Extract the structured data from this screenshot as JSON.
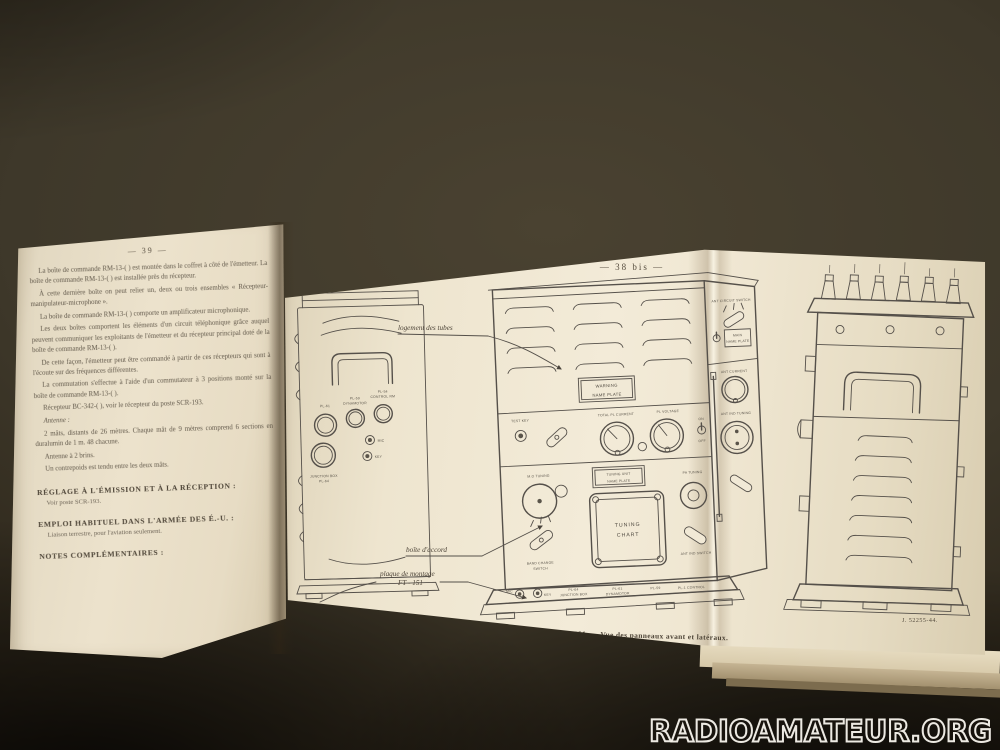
{
  "watermark": {
    "text": "RADIOAMATEUR.ORG"
  },
  "left_page": {
    "page_number": "— 39 —",
    "paragraphs": [
      "La boîte de commande RM-13-( ) est montée dans le coffret à côté de l'émetteur. La boîte de commande RM-13-( ) est installée près du récepteur.",
      "À cette dernière boîte on peut relier un, deux ou trois ensembles « Récepteur-manipulateur-microphone ».",
      "La boîte de commande RM-13-( ) comporte un amplificateur microphonique.",
      "Les deux boîtes comportent les éléments d'un circuit téléphonique grâce auquel peuvent communiquer les exploitants de l'émetteur et du récepteur principal doté de la boîte de commande RM-13-( ).",
      "De cette façon, l'émetteur peut être commandé à partir de ces récepteurs qui sont à l'écoute sur des fréquences différentes.",
      "La commutation s'effectue à l'aide d'un commutateur à 3 positions monté sur la boîte de commande RM-13-( ).",
      "Récepteur BC-342-( ), voir le récepteur du poste SCR-193.",
      "Antenne :",
      "2 mâts, distants de 26 mètres. Chaque mât de 9 mètres comprend 6 sections en duralumin de 1 m. 48 chacune.",
      "Antenne à 2 brins.",
      "Un contrepoids est tendu entre les deux mâts."
    ],
    "sections": [
      {
        "heading": "RÉGLAGE À L'ÉMISSION ET À LA RÉCEPTION :",
        "body": "Voir poste SCR-193."
      },
      {
        "heading": "EMPLOI HABITUEL DANS L'ARMÉE DES É.-U. :",
        "body": "Liaison terrestre, pour l'aviation seulement."
      },
      {
        "heading": "NOTES COMPLÉMENTAIRES :",
        "body": ""
      }
    ]
  },
  "foldout": {
    "page_number": "— 38 bis —",
    "figure_caption": "Fig. 1. — Émetteur BC-191. — Vue des panneaux avant et latéraux.",
    "plate_ref": "J. 52255-44.",
    "callouts": {
      "tubes": "logement des tubes",
      "accord": "boîte d'accord",
      "montage_line1": "plaque de montage",
      "montage_line2": "FT - 151"
    },
    "labels": {
      "warning_plate_1": "WARNING",
      "warning_plate_2": "NAME PLATE",
      "total_pl_current": "TOTAL PL CURRENT",
      "pl_voltage": "PL VOLTAGE",
      "test_key": "TEST KEY",
      "on": "ON",
      "off": "OFF",
      "tuning_unit_plate_1": "TUNING UNIT",
      "tuning_unit_plate_2": "NAME PLATE",
      "tuning_chart_1": "TUNING",
      "tuning_chart_2": "CHART",
      "mo_tuning": "M.O TUNING",
      "band_change_1": "BAND CHANGE",
      "band_change_2": "SWITCH",
      "pa_tuning": "PA TUNING",
      "ant_current": "ANT CURRENT",
      "ant_ind_tuning": "ANT IND TUNING",
      "ant_circuit_switch": "ANT CIRCUIT SWITCH",
      "ant_ind_switch": "ANT IND SWITCH",
      "main_plate_1": "MAIN",
      "main_plate_2": "NAME PLATE",
      "mic": "MIC",
      "key": "KEY",
      "pl64": "PL-64",
      "junction_box": "JUNCTION BOX",
      "pl61": "PL-61",
      "dynamotor": "DYNAMOTOR",
      "pl59": "PL-59",
      "pl1_control": "PL-1 CONTROL",
      "left_pl61": "PL-61",
      "left_pl59": "PL-59",
      "left_pl54": "PL-54",
      "left_dynamotor": "DYNAMOTOR",
      "left_control": "CONTROL RM",
      "left_mic": "MIC",
      "left_key": "KEY",
      "left_junction_1": "JUNCTION BOX",
      "left_junction_2": "PL-64"
    }
  }
}
